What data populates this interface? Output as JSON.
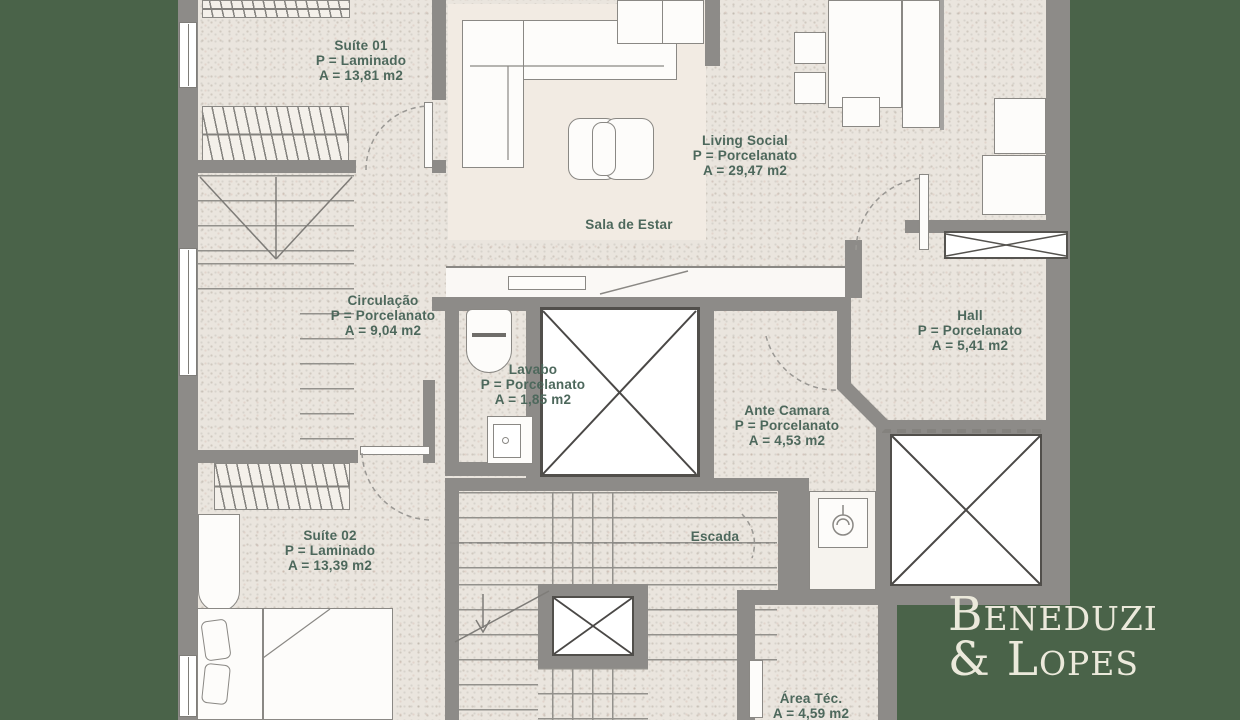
{
  "brand": {
    "line1": "Beneduzi",
    "line2": "& Lopes"
  },
  "rooms": {
    "suite_01": {
      "name": "Suíte 01",
      "floor": "P = Laminado",
      "area": "A = 13,81 m2"
    },
    "living_social": {
      "name": "Living Social",
      "floor": "P = Porcelanato",
      "area": "A = 29,47 m2"
    },
    "sala_de_estar": {
      "name": "Sala de Estar"
    },
    "circulacao": {
      "name": "Circulação",
      "floor": "P = Porcelanato",
      "area": "A = 9,04 m2"
    },
    "lavabo": {
      "name": "Lavabo",
      "floor": "P = Porcelanato",
      "area": "A = 1,85 m2"
    },
    "hall": {
      "name": "Hall",
      "floor": "P = Porcelanato",
      "area": "A = 5,41 m2"
    },
    "ante_camara": {
      "name": "Ante Camara",
      "floor": "P = Porcelanato",
      "area": "A = 4,53 m2"
    },
    "suite_02": {
      "name": "Suíte 02",
      "floor": "P = Laminado",
      "area": "A = 13,39 m2"
    },
    "escada": {
      "name": "Escada"
    },
    "area_tec": {
      "name": "Área Téc.",
      "area": "A = 4,59 m2"
    }
  },
  "colors": {
    "background_green": "#4a6349",
    "floor_beige": "#eae5de",
    "rug_cream": "#f2ebe3",
    "wall_gray": "#8d8b88",
    "label_green": "#4d685c",
    "brand_cream": "#ebe9db"
  }
}
